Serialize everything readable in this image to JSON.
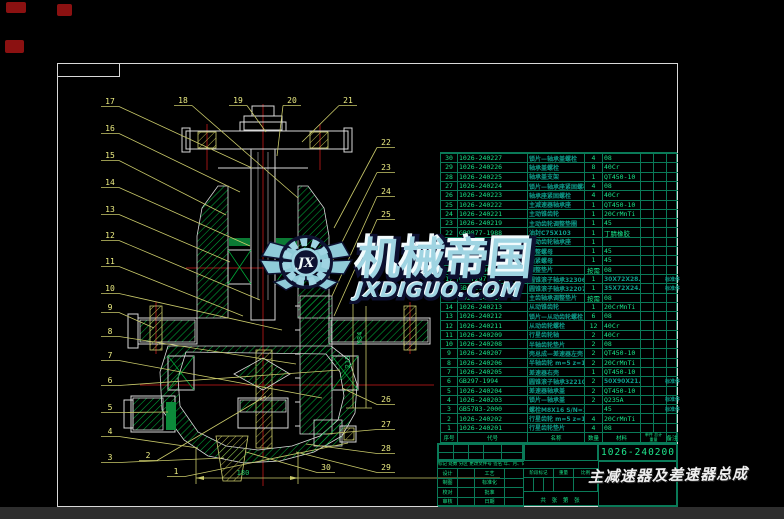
{
  "watermark": {
    "brand": "机械帝国",
    "site": "JXDIGUO.COM",
    "monogram": "JX"
  },
  "title_block": {
    "drawing_no": "1026-240200",
    "product_title": "主减速器及差速器总成",
    "rev_note": "标记 处数 分区 更改文件号 签名 年、月、日",
    "rows": [
      [
        "设计",
        "工艺"
      ],
      [
        "制图",
        "标准化"
      ],
      [
        "校对",
        "批准"
      ],
      [
        "审核",
        "日期"
      ]
    ],
    "stage": "阶段标记",
    "weight": "重量",
    "scale": "比例",
    "sheets": "共 张 第 张"
  },
  "bom": {
    "headers": {
      "seq": "序号",
      "code": "代号",
      "name": "名称",
      "qty": "数量",
      "mat": "材料",
      "unit": "单件",
      "total": "总计",
      "weight": "重量",
      "rem": "备注"
    },
    "rows": [
      [
        "30",
        "1026-240227",
        "锁片—轴承盖螺栓",
        "4",
        "08",
        ""
      ],
      [
        "29",
        "1026-240226",
        "轴承盖螺栓",
        "8",
        "40Cr",
        ""
      ],
      [
        "28",
        "1026-240225",
        "轴承盖支架",
        "1",
        "QT450-10",
        ""
      ],
      [
        "27",
        "1026-240224",
        "锁片—轴承座紧固螺栓",
        "4",
        "08",
        ""
      ],
      [
        "26",
        "1026-240223",
        "轴承座紧固螺栓",
        "4",
        "40Cr",
        ""
      ],
      [
        "25",
        "1026-240222",
        "主减速器轴承座",
        "1",
        "QT450-10",
        ""
      ],
      [
        "24",
        "1026-240221",
        "主动锥齿轮",
        "1",
        "20CrMnTi",
        ""
      ],
      [
        "23",
        "1026-240219",
        "主动齿轮调整垫圈",
        "1",
        "45",
        ""
      ],
      [
        "22",
        "GB9877-1988",
        "油封C75X103",
        "1",
        "丁腈橡胶",
        ""
      ],
      [
        "21",
        "1026-240218",
        "主动齿轮轴承座",
        "1",
        "",
        ""
      ],
      [
        "20",
        "1026-240217",
        "调整螺母",
        "1",
        "45",
        ""
      ],
      [
        "19",
        "1026-240216",
        "锁紧螺母",
        "1",
        "45",
        ""
      ],
      [
        "18",
        "1026-240215",
        "调整垫片",
        "按需",
        "08",
        ""
      ],
      [
        "17",
        "GB/T297-1994",
        "圆锥滚子轴承32306",
        "1",
        "30X72X28.75",
        "标准件"
      ],
      [
        "16",
        "GB/T297-1994",
        "圆锥滚子轴承32207",
        "1",
        "35X72X24.25",
        "标准件"
      ],
      [
        "15",
        "1026-240214",
        "主齿轴承调整垫片",
        "按需",
        "08",
        ""
      ],
      [
        "14",
        "1026-240213",
        "从动锥齿轮",
        "1",
        "20CrMnTi",
        ""
      ],
      [
        "13",
        "1026-240212",
        "锁片—从动齿轮螺栓",
        "6",
        "08",
        ""
      ],
      [
        "12",
        "1026-240211",
        "从动齿轮螺栓",
        "12",
        "40Cr",
        ""
      ],
      [
        "11",
        "1026-240209",
        "行星齿轮轴",
        "2",
        "40Cr",
        ""
      ],
      [
        "10",
        "1026-240208",
        "半轴齿轮垫片",
        "2",
        "08",
        ""
      ],
      [
        "9",
        "1026-240207",
        "壳总成—差速器左壳",
        "2",
        "QT450-10",
        ""
      ],
      [
        "8",
        "1026-240206",
        "半轴齿轮 m=5 z=16",
        "2",
        "20CrMnTi",
        ""
      ],
      [
        "7",
        "1026-240205",
        "差速器右壳",
        "1",
        "QT450-10",
        ""
      ],
      [
        "6",
        "GB297-1994",
        "圆锥滚子轴承32210",
        "2",
        "50X90X21.75",
        "标准件"
      ],
      [
        "5",
        "1026-240204",
        "差速器轴承盖",
        "2",
        "QT450-10",
        ""
      ],
      [
        "4",
        "1026-240203",
        "锁片—轴承盖",
        "2",
        "Q235A",
        "标准件"
      ],
      [
        "3",
        "GB5783-2000",
        "螺栓M8X16 S/N=13",
        "",
        "45",
        "标准件"
      ],
      [
        "2",
        "1026-240202",
        "行星齿轮 m=5 z=10",
        "4",
        "20CrMnTi",
        ""
      ],
      [
        "1",
        "1026-240201",
        "行星齿轮垫片",
        "4",
        "08",
        ""
      ]
    ]
  },
  "drawing": {
    "dim_bottom": "180",
    "dim_side_a": "M84",
    "dim_side_b": "215",
    "callouts": [
      {
        "n": "17",
        "x": 110,
        "y": 104,
        "tx": 252,
        "ty": 168
      },
      {
        "n": "16",
        "x": 110,
        "y": 131,
        "tx": 240,
        "ty": 192
      },
      {
        "n": "15",
        "x": 110,
        "y": 158,
        "tx": 226,
        "ty": 215
      },
      {
        "n": "14",
        "x": 110,
        "y": 185,
        "tx": 250,
        "ty": 246
      },
      {
        "n": "13",
        "x": 110,
        "y": 212,
        "tx": 230,
        "ty": 262
      },
      {
        "n": "12",
        "x": 110,
        "y": 238,
        "tx": 260,
        "ty": 300
      },
      {
        "n": "11",
        "x": 110,
        "y": 264,
        "tx": 243,
        "ty": 316
      },
      {
        "n": "10",
        "x": 110,
        "y": 291,
        "tx": 282,
        "ty": 330
      },
      {
        "n": "9",
        "x": 110,
        "y": 310,
        "tx": 154,
        "ty": 328
      },
      {
        "n": "8",
        "x": 110,
        "y": 334,
        "tx": 296,
        "ty": 364
      },
      {
        "n": "7",
        "x": 110,
        "y": 358,
        "tx": 322,
        "ty": 398
      },
      {
        "n": "6",
        "x": 110,
        "y": 383,
        "tx": 340,
        "ty": 370
      },
      {
        "n": "5",
        "x": 110,
        "y": 410,
        "tx": 168,
        "ty": 412
      },
      {
        "n": "4",
        "x": 110,
        "y": 434,
        "tx": 198,
        "ty": 448
      },
      {
        "n": "3",
        "x": 110,
        "y": 460,
        "tx": 224,
        "ty": 458
      },
      {
        "n": "2",
        "x": 148,
        "y": 458,
        "tx": 266,
        "ty": 396
      },
      {
        "n": "1",
        "x": 176,
        "y": 474,
        "tx": 348,
        "ty": 443
      },
      {
        "n": "18",
        "x": 183,
        "y": 103,
        "tx": 298,
        "ty": 198
      },
      {
        "n": "19",
        "x": 238,
        "y": 103,
        "tx": 266,
        "ty": 132
      },
      {
        "n": "20",
        "x": 292,
        "y": 103,
        "tx": 277,
        "ty": 156
      },
      {
        "n": "21",
        "x": 348,
        "y": 103,
        "tx": 302,
        "ty": 142
      },
      {
        "n": "22",
        "x": 386,
        "y": 145,
        "tx": 334,
        "ty": 228
      },
      {
        "n": "23",
        "x": 386,
        "y": 170,
        "tx": 332,
        "ty": 262
      },
      {
        "n": "24",
        "x": 386,
        "y": 194,
        "tx": 332,
        "ty": 296
      },
      {
        "n": "25",
        "x": 386,
        "y": 217,
        "tx": 334,
        "ty": 316
      },
      {
        "n": "26",
        "x": 386,
        "y": 402,
        "tx": 342,
        "ty": 388
      },
      {
        "n": "27",
        "x": 386,
        "y": 427,
        "tx": 326,
        "ty": 434
      },
      {
        "n": "28",
        "x": 386,
        "y": 451,
        "tx": 306,
        "ty": 444
      },
      {
        "n": "29",
        "x": 386,
        "y": 470,
        "tx": 296,
        "ty": 452
      },
      {
        "n": "30",
        "x": 326,
        "y": 470,
        "tx": 246,
        "ty": 452
      }
    ]
  }
}
